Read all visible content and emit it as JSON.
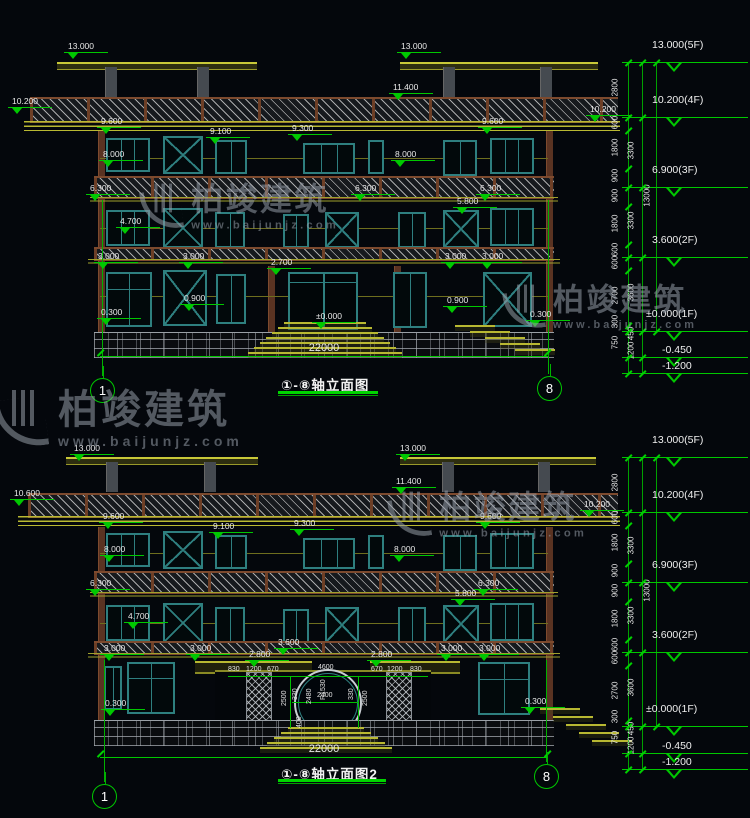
{
  "meta": {
    "brand": "柏竣建筑",
    "site": "www.baijunjz.com"
  },
  "colors": {
    "background": "#04070c",
    "dim_green": "#00c800",
    "text_white": "#e8e8e8",
    "building_yellow": "#b8b832",
    "window_teal": "#2e7f7f",
    "slab_brown": "#7d4a2e"
  },
  "watermarks": [
    {
      "x": 140,
      "y": 182,
      "s": 0.8
    },
    {
      "x": -6,
      "y": 388,
      "s": 1.0
    },
    {
      "x": 503,
      "y": 283,
      "s": 0.78
    },
    {
      "x": 388,
      "y": 490,
      "s": 0.8
    }
  ],
  "drawings": [
    {
      "title": "①-⑧轴立面图",
      "axis_left": "1",
      "axis_right": "8",
      "width_dim": "22000",
      "elev_labels": [
        {
          "t": "13.000",
          "x": 68,
          "y": 42
        },
        {
          "t": "13.000",
          "x": 401,
          "y": 42
        },
        {
          "t": "11.400",
          "x": 393,
          "y": 83
        },
        {
          "t": "10.200",
          "x": 12,
          "y": 97
        },
        {
          "t": "10.200",
          "x": 590,
          "y": 105
        },
        {
          "t": "9.600",
          "x": 101,
          "y": 117
        },
        {
          "t": "9.100",
          "x": 210,
          "y": 127
        },
        {
          "t": "9.300",
          "x": 292,
          "y": 124
        },
        {
          "t": "9.600",
          "x": 482,
          "y": 117
        },
        {
          "t": "8.000",
          "x": 103,
          "y": 150
        },
        {
          "t": "8.000",
          "x": 395,
          "y": 150
        },
        {
          "t": "6.300",
          "x": 90,
          "y": 184
        },
        {
          "t": "6.300",
          "x": 355,
          "y": 184
        },
        {
          "t": "6.300",
          "x": 480,
          "y": 184
        },
        {
          "t": "5.800",
          "x": 457,
          "y": 197
        },
        {
          "t": "4.700",
          "x": 120,
          "y": 217
        },
        {
          "t": "3.000",
          "x": 98,
          "y": 252
        },
        {
          "t": "3.000",
          "x": 183,
          "y": 252
        },
        {
          "t": "2.700",
          "x": 271,
          "y": 258
        },
        {
          "t": "3.000",
          "x": 445,
          "y": 252
        },
        {
          "t": "3.000",
          "x": 482,
          "y": 252
        },
        {
          "t": "0.900",
          "x": 184,
          "y": 294
        },
        {
          "t": "0.900",
          "x": 447,
          "y": 296
        },
        {
          "t": "0.300",
          "x": 101,
          "y": 308
        },
        {
          "t": "0.300",
          "x": 530,
          "y": 310
        },
        {
          "t": "±0.000",
          "x": 316,
          "y": 312
        }
      ],
      "levels": [
        {
          "t": "13.000(5F)",
          "x": 652,
          "y": 39,
          "ly": 62
        },
        {
          "t": "10.200(4F)",
          "x": 652,
          "y": 94,
          "ly": 117
        },
        {
          "t": "6.900(3F)",
          "x": 652,
          "y": 164,
          "ly": 187
        },
        {
          "t": "3.600(2F)",
          "x": 652,
          "y": 234,
          "ly": 257
        },
        {
          "t": "±0.000(1F)",
          "x": 646,
          "y": 308,
          "ly": 331
        },
        {
          "t": "-0.450",
          "x": 662,
          "y": 344,
          "ly": 357
        },
        {
          "t": "-1.200",
          "x": 662,
          "y": 360,
          "ly": 373
        }
      ],
      "chain1": [
        {
          "t": "2800",
          "y": 88
        },
        {
          "t": "600",
          "y": 123
        },
        {
          "t": "1800",
          "y": 148
        },
        {
          "t": "900",
          "y": 176
        },
        {
          "t": "900",
          "y": 196
        },
        {
          "t": "1800",
          "y": 224
        },
        {
          "t": "600",
          "y": 250
        },
        {
          "t": "600",
          "y": 263
        },
        {
          "t": "2700",
          "y": 296
        },
        {
          "t": "300",
          "y": 322
        },
        {
          "t": "750",
          "y": 343
        }
      ],
      "chain2": [
        {
          "t": "3300",
          "y": 151
        },
        {
          "t": "3300",
          "y": 221
        },
        {
          "t": "3600",
          "y": 293
        },
        {
          "t": "450",
          "y": 334
        },
        {
          "t": "1200",
          "y": 351
        }
      ],
      "chain3": [
        {
          "t": "13000",
          "y": 196
        }
      ],
      "ticks_a": [
        62,
        117,
        130,
        168,
        187,
        206,
        244,
        257,
        270,
        325,
        331,
        357,
        373
      ],
      "ticks_b": [
        62,
        117,
        187,
        257,
        331,
        357,
        373
      ],
      "ticks_c": [
        62,
        331
      ]
    },
    {
      "title": "①-⑧轴立面图2",
      "axis_left": "1",
      "axis_right": "8",
      "width_dim": "22000",
      "elev_labels": [
        {
          "t": "13.000",
          "x": 74,
          "y": 444
        },
        {
          "t": "13.000",
          "x": 400,
          "y": 444
        },
        {
          "t": "11.400",
          "x": 396,
          "y": 477
        },
        {
          "t": "10.600",
          "x": 14,
          "y": 489
        },
        {
          "t": "10.200",
          "x": 584,
          "y": 500
        },
        {
          "t": "9.600",
          "x": 103,
          "y": 512
        },
        {
          "t": "9.100",
          "x": 213,
          "y": 522
        },
        {
          "t": "9.300",
          "x": 294,
          "y": 519
        },
        {
          "t": "9.600",
          "x": 480,
          "y": 512
        },
        {
          "t": "8.000",
          "x": 104,
          "y": 545
        },
        {
          "t": "8.000",
          "x": 394,
          "y": 545
        },
        {
          "t": "6.300",
          "x": 90,
          "y": 579
        },
        {
          "t": "6.300",
          "x": 478,
          "y": 579
        },
        {
          "t": "5.800",
          "x": 455,
          "y": 589
        },
        {
          "t": "4.700",
          "x": 128,
          "y": 612
        },
        {
          "t": "3.000",
          "x": 104,
          "y": 644
        },
        {
          "t": "3.000",
          "x": 190,
          "y": 644
        },
        {
          "t": "3.600",
          "x": 278,
          "y": 638
        },
        {
          "t": "2.800",
          "x": 249,
          "y": 650
        },
        {
          "t": "2.800",
          "x": 371,
          "y": 650
        },
        {
          "t": "3.000",
          "x": 441,
          "y": 644
        },
        {
          "t": "3.000",
          "x": 479,
          "y": 644
        },
        {
          "t": "0.300",
          "x": 105,
          "y": 699
        },
        {
          "t": "0.300",
          "x": 525,
          "y": 697
        }
      ],
      "entrance_dims": [
        {
          "t": "830",
          "x": 228,
          "y": 666
        },
        {
          "t": "1200",
          "x": 246,
          "y": 666
        },
        {
          "t": "670",
          "x": 267,
          "y": 666
        },
        {
          "t": "4600",
          "x": 318,
          "y": 664
        },
        {
          "t": "670",
          "x": 371,
          "y": 666
        },
        {
          "t": "1200",
          "x": 387,
          "y": 666
        },
        {
          "t": "830",
          "x": 410,
          "y": 666
        },
        {
          "t": "330",
          "x": 292,
          "y": 700,
          "rot": true
        },
        {
          "t": "2400",
          "x": 317,
          "y": 692
        },
        {
          "t": "330",
          "x": 348,
          "y": 700,
          "rot": true
        },
        {
          "t": "2480",
          "x": 306,
          "y": 704,
          "rot": true
        },
        {
          "t": "R1530",
          "x": 320,
          "y": 700,
          "rot": true
        },
        {
          "t": "2500",
          "x": 281,
          "y": 706,
          "rot": true
        },
        {
          "t": "2500",
          "x": 362,
          "y": 706,
          "rot": true
        },
        {
          "t": "400",
          "x": 296,
          "y": 728,
          "rot": true
        }
      ],
      "levels": [
        {
          "t": "13.000(5F)",
          "x": 652,
          "y": 434,
          "ly": 457
        },
        {
          "t": "10.200(4F)",
          "x": 652,
          "y": 489,
          "ly": 512
        },
        {
          "t": "6.900(3F)",
          "x": 652,
          "y": 559,
          "ly": 582
        },
        {
          "t": "3.600(2F)",
          "x": 652,
          "y": 629,
          "ly": 652
        },
        {
          "t": "±0.000(1F)",
          "x": 646,
          "y": 703,
          "ly": 726
        },
        {
          "t": "-0.450",
          "x": 662,
          "y": 740,
          "ly": 753
        },
        {
          "t": "-1.200",
          "x": 662,
          "y": 756,
          "ly": 769
        }
      ],
      "chain1": [
        {
          "t": "2800",
          "y": 483
        },
        {
          "t": "600",
          "y": 518
        },
        {
          "t": "1800",
          "y": 543
        },
        {
          "t": "900",
          "y": 571
        },
        {
          "t": "900",
          "y": 591
        },
        {
          "t": "1800",
          "y": 619
        },
        {
          "t": "600",
          "y": 645
        },
        {
          "t": "600",
          "y": 658
        },
        {
          "t": "2700",
          "y": 691
        },
        {
          "t": "300",
          "y": 717
        },
        {
          "t": "750",
          "y": 738
        }
      ],
      "chain2": [
        {
          "t": "3300",
          "y": 546
        },
        {
          "t": "3300",
          "y": 616
        },
        {
          "t": "3600",
          "y": 688
        },
        {
          "t": "450",
          "y": 729
        },
        {
          "t": "1200",
          "y": 746
        }
      ],
      "chain3": [
        {
          "t": "13000",
          "y": 591
        }
      ],
      "ticks_a": [
        457,
        512,
        525,
        563,
        582,
        601,
        639,
        652,
        665,
        720,
        726,
        753,
        769
      ],
      "ticks_b": [
        457,
        512,
        582,
        652,
        726,
        753,
        769
      ],
      "ticks_c": [
        457,
        726
      ]
    }
  ]
}
